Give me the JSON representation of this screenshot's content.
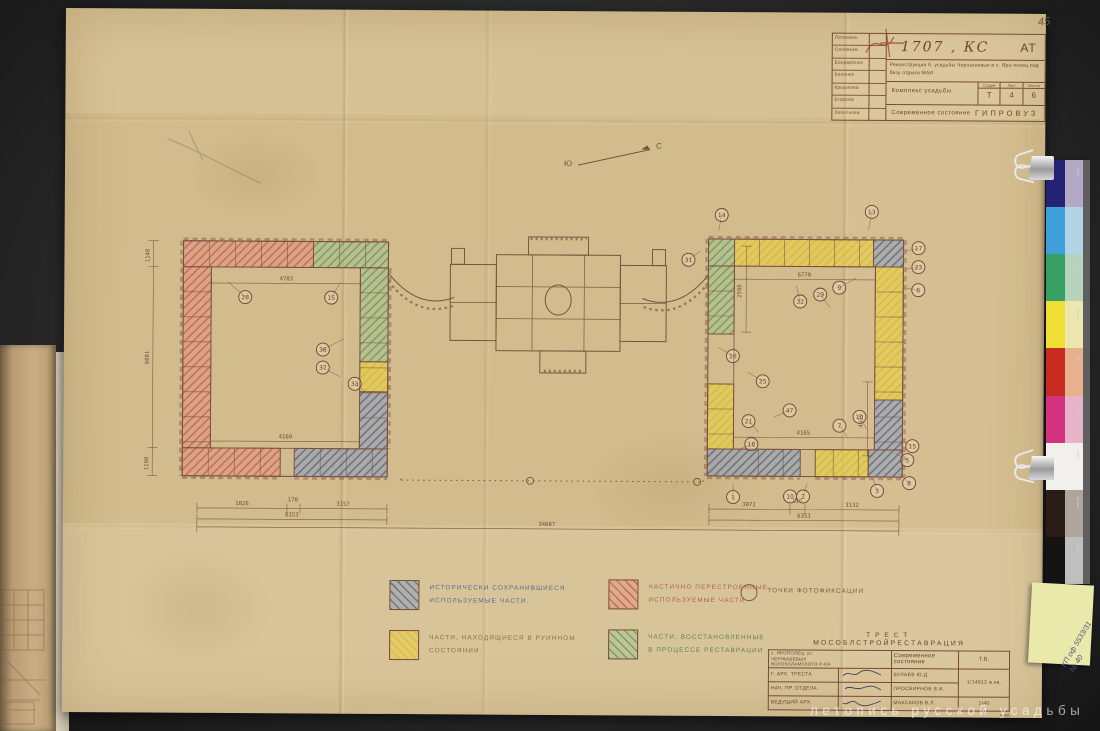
{
  "photo": {
    "page_number": "45",
    "watermark": "летопись русской усадьбы",
    "sticky_note": {
      "line1": "КП оф 5533/31",
      "line2": "№ 40"
    },
    "color_strip_labels": [
      "blue",
      "cyan",
      "green",
      "yellow",
      "red",
      "magenta",
      "white",
      "brown",
      "black"
    ],
    "color_strip": [
      {
        "main": "#262273",
        "light": "#b3a8c6"
      },
      {
        "main": "#3fa0dc",
        "light": "#b2d3e6"
      },
      {
        "main": "#37a164",
        "light": "#b7d3bb"
      },
      {
        "main": "#efdf33",
        "light": "#ebe7ae"
      },
      {
        "main": "#c92b21",
        "light": "#e8b18d"
      },
      {
        "main": "#d43380",
        "light": "#e6b3c7"
      },
      {
        "main": "#f2f0ec",
        "light": "#f2f0ec"
      },
      {
        "main": "#2a1d17",
        "light": "#aea69a"
      },
      {
        "main": "#141414",
        "light": "#bfbfbf"
      }
    ]
  },
  "stamp_top": {
    "number": "1707",
    "type_code": "КС",
    "series": "АТ",
    "project_line": "Реконструкция б. усадьбы Чернышевых в с. Яро-полец под базу отдыха МАИ",
    "object": "Комплекс усадьбы",
    "stage_label": "Стадия",
    "sheet_label": "Лист",
    "sheets_label": "Листов",
    "stage": "Т",
    "sheet": "4",
    "sheets": "6",
    "subtitle": "Современное состояние",
    "org": "ГИПРОВУЗ",
    "names": [
      "Потемкин",
      "Соловьев",
      "Бондаренко",
      "Клеенко",
      "Крышкова",
      "Егорова",
      "Леонтьева"
    ]
  },
  "north": {
    "south": "Ю",
    "north": "С"
  },
  "legend": {
    "items": [
      {
        "line1": "Исторически сохранившиеся",
        "line2": "используемые части.",
        "ink": "#5a6a8e"
      },
      {
        "line1": "Частично перестроенные",
        "line2": "используемые части",
        "ink": "#b06055"
      },
      {
        "line1": "Точки фотофиксации",
        "line2": "",
        "ink": "#7a5a40"
      },
      {
        "line1": "Части, находящиеся в руинном",
        "line2": "состоянии.",
        "ink": "#8a7340"
      },
      {
        "line1": "Части, восстановленные",
        "line2": "в процессе реставрации",
        "ink": "#5e8456"
      }
    ]
  },
  "plan": {
    "dims": [
      {
        "x": 125,
        "y": 319,
        "v": "1826"
      },
      {
        "x": 176,
        "y": 315,
        "v": "170"
      },
      {
        "x": 226,
        "y": 319,
        "v": "3157"
      },
      {
        "x": 175,
        "y": 330,
        "v": "6153"
      },
      {
        "x": 430,
        "y": 338,
        "v": "34687"
      },
      {
        "x": 632,
        "y": 317,
        "v": "3072"
      },
      {
        "x": 680,
        "y": 313,
        "v": "150"
      },
      {
        "x": 735,
        "y": 317,
        "v": "3132"
      },
      {
        "x": 687,
        "y": 328,
        "v": "6353"
      },
      {
        "x": 168,
        "y": 94,
        "v": "4783"
      },
      {
        "x": 168,
        "y": 252,
        "v": "4160"
      },
      {
        "x": 686,
        "y": 87,
        "v": "6770"
      },
      {
        "x": 686,
        "y": 245,
        "v": "4165"
      },
      {
        "x": 31,
        "y": 70,
        "v": "1140",
        "rot": true
      },
      {
        "x": 31,
        "y": 172,
        "v": "6081",
        "rot": true
      },
      {
        "x": 31,
        "y": 278,
        "v": "1190",
        "rot": true
      },
      {
        "x": 623,
        "y": 102,
        "v": "2596",
        "rot": true
      },
      {
        "x": 745,
        "y": 231,
        "v": "4959",
        "rot": true
      }
    ],
    "callouts": [
      {
        "x": 127,
        "y": 111,
        "n": "28",
        "lx": 110,
        "ly": 96
      },
      {
        "x": 213,
        "y": 111,
        "n": "15",
        "lx": 222,
        "ly": 96
      },
      {
        "x": 205,
        "y": 163,
        "n": "36",
        "lx": 226,
        "ly": 152
      },
      {
        "x": 205,
        "y": 181,
        "n": "37",
        "lx": 222,
        "ly": 190
      },
      {
        "x": 237,
        "y": 197,
        "n": "33",
        "lx": 250,
        "ly": 206
      },
      {
        "x": 570,
        "y": 71,
        "n": "31",
        "lx": 582,
        "ly": 62
      },
      {
        "x": 603,
        "y": 26,
        "n": "14",
        "lx": 600,
        "ly": 42
      },
      {
        "x": 753,
        "y": 22,
        "n": "13",
        "lx": 750,
        "ly": 40
      },
      {
        "x": 682,
        "y": 112,
        "n": "32",
        "lx": 678,
        "ly": 96
      },
      {
        "x": 702,
        "y": 105,
        "n": "29",
        "lx": 712,
        "ly": 118
      },
      {
        "x": 721,
        "y": 98,
        "n": "9",
        "lx": 738,
        "ly": 88
      },
      {
        "x": 615,
        "y": 167,
        "n": "16",
        "lx": 600,
        "ly": 158
      },
      {
        "x": 645,
        "y": 192,
        "n": "25",
        "lx": 630,
        "ly": 183
      },
      {
        "x": 672,
        "y": 221,
        "n": "47",
        "lx": 656,
        "ly": 228
      },
      {
        "x": 631,
        "y": 232,
        "n": "21",
        "lx": 641,
        "ly": 243
      },
      {
        "x": 634,
        "y": 255,
        "n": "18",
        "lx": 620,
        "ly": 261
      },
      {
        "x": 722,
        "y": 236,
        "n": "7",
        "lx": 730,
        "ly": 247
      },
      {
        "x": 742,
        "y": 227,
        "n": "10",
        "lx": 749,
        "ly": 239
      },
      {
        "x": 795,
        "y": 256,
        "n": "15",
        "lx": 783,
        "ly": 250
      },
      {
        "x": 790,
        "y": 270,
        "n": "5",
        "lx": 778,
        "ly": 263
      },
      {
        "x": 616,
        "y": 308,
        "n": "1",
        "lx": 616,
        "ly": 295
      },
      {
        "x": 673,
        "y": 307,
        "n": "10"
      },
      {
        "x": 686,
        "y": 307,
        "n": "2",
        "lx": 690,
        "ly": 294
      },
      {
        "x": 760,
        "y": 301,
        "n": "3",
        "lx": 756,
        "ly": 289
      },
      {
        "x": 792,
        "y": 293,
        "n": "8",
        "lx": 782,
        "ly": 283
      },
      {
        "x": 800,
        "y": 58,
        "n": "17",
        "lx": 788,
        "ly": 61
      },
      {
        "x": 800,
        "y": 77,
        "n": "23",
        "lx": 788,
        "ly": 79
      },
      {
        "x": 800,
        "y": 100,
        "n": "6",
        "lx": 788,
        "ly": 98
      }
    ]
  },
  "stamp_bottom": {
    "org_line1": "ТРЕСТ",
    "org_line2": "МОСОБЛСТРОЙРЕСТАВРАЦИЯ",
    "address_line1": "с. ЯРОПОЛЕЦ, ус.",
    "address_line2": "ЧЕРНЫШЕВЫХ",
    "address_line3": "ВОЛОКОЛАМСКОГО Р-НА",
    "subtitle": "Современное состояние",
    "mark": "Т.В.",
    "rows": [
      {
        "role": "Г. АРХ. ТРЕСТА",
        "name": "БУЛАЕВ Ю.Д."
      },
      {
        "role": "НАЧ. ПР. ОТДЕЛА",
        "name": "ПРОСВИРНОВ В.И."
      },
      {
        "role": "ВЕДУЩИЙ АРХ.",
        "name": "МАКСАКОВ В.Л."
      }
    ],
    "doc_no": "1/14912 ж.кв.",
    "doc_no2": "1/40",
    "doc_no3": "и-4А"
  }
}
